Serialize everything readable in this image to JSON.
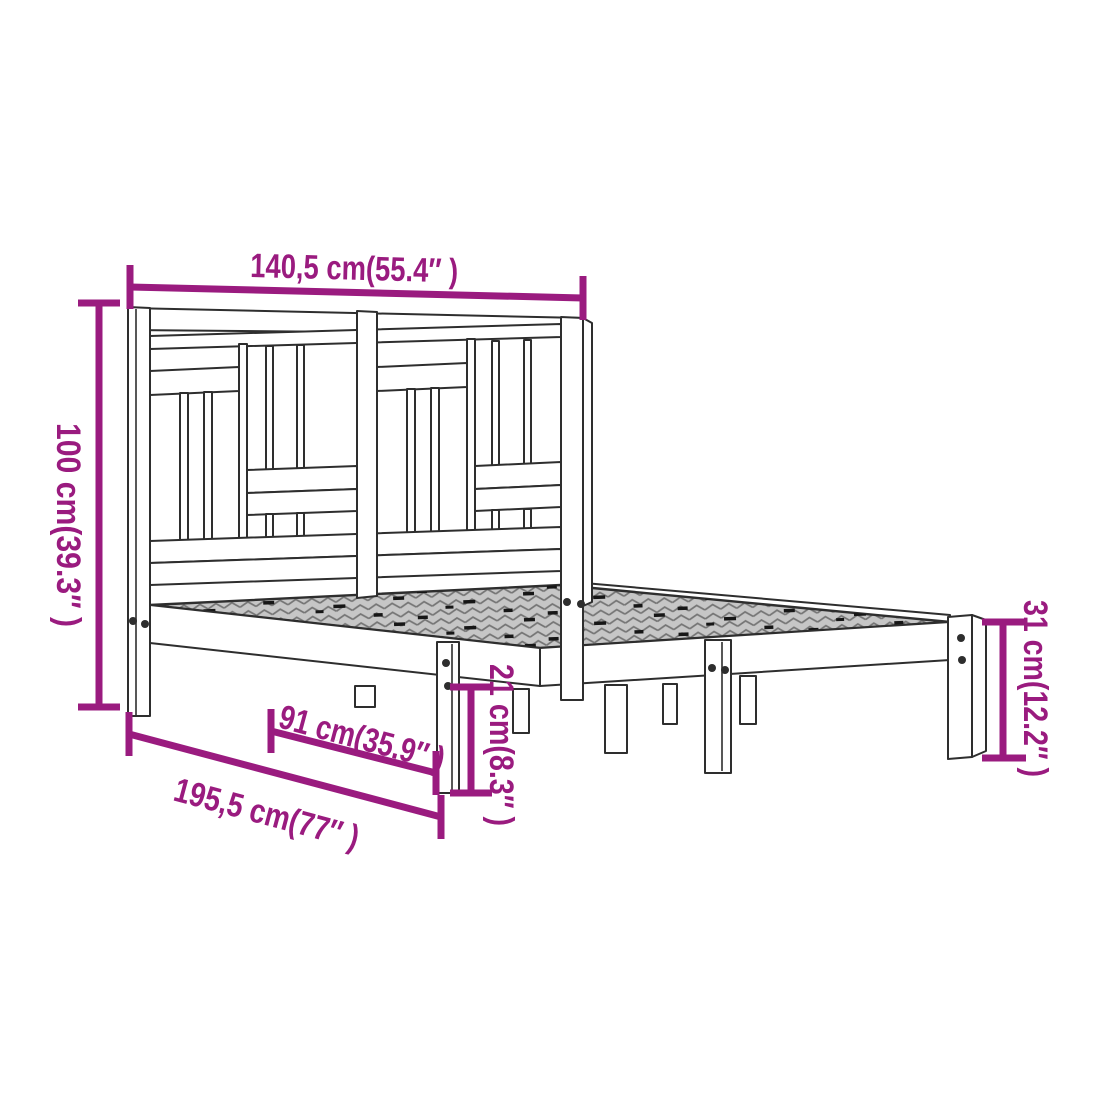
{
  "diagram": {
    "subject": "bed-frame-dimension-diagram",
    "dimensions": {
      "width": "140,5 cm(55.4″ )",
      "headboard_height": "100 cm(39.3″ )",
      "platform_height": "31 cm(12.2″ )",
      "under_bed_clearance": "21 cm(8.3″ )",
      "inner_length": "91 cm(35.9″ )",
      "frame_length": "195,5 cm(77″ )"
    },
    "colors": {
      "dimension": "#9a1b7f",
      "outline": "#2e2e2e",
      "deck_base": "#c6c6c6",
      "deck_hatch": "#757575",
      "background": "#ffffff"
    }
  }
}
